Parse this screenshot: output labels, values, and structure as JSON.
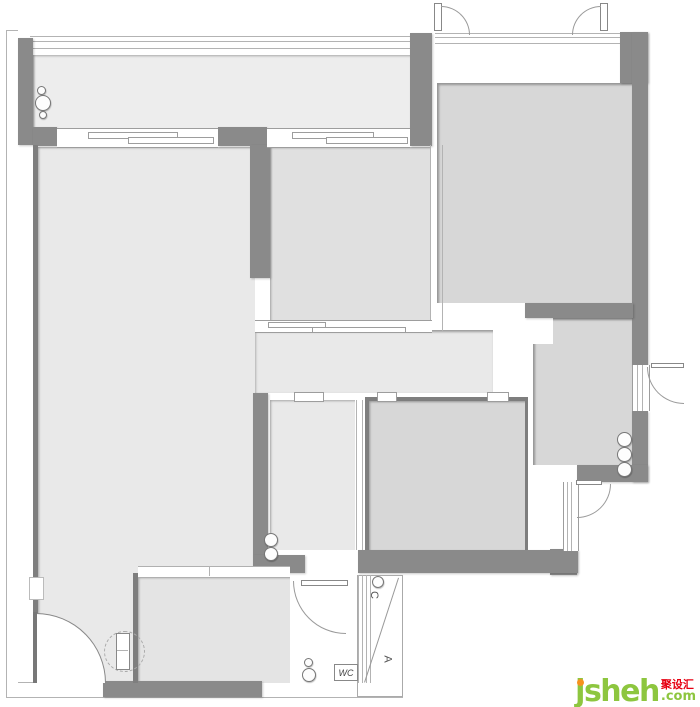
{
  "labels": {
    "wc": "WC",
    "ac_marker_top": "C",
    "ac_marker_bottom": "A"
  },
  "watermark": {
    "brand": "jsheh",
    "cn": "聚设汇",
    "tld": ".com"
  },
  "colors": {
    "wall": "#8a8a8a",
    "room_fill_light": "#e9e9e9",
    "room_fill_mid": "#e0e0e0",
    "room_fill_dark": "#d7d7d7",
    "balcony_fill": "#ededed",
    "brand_green": "#8dc63f",
    "brand_orange": "#f6921e",
    "brand_red": "#e60012"
  }
}
